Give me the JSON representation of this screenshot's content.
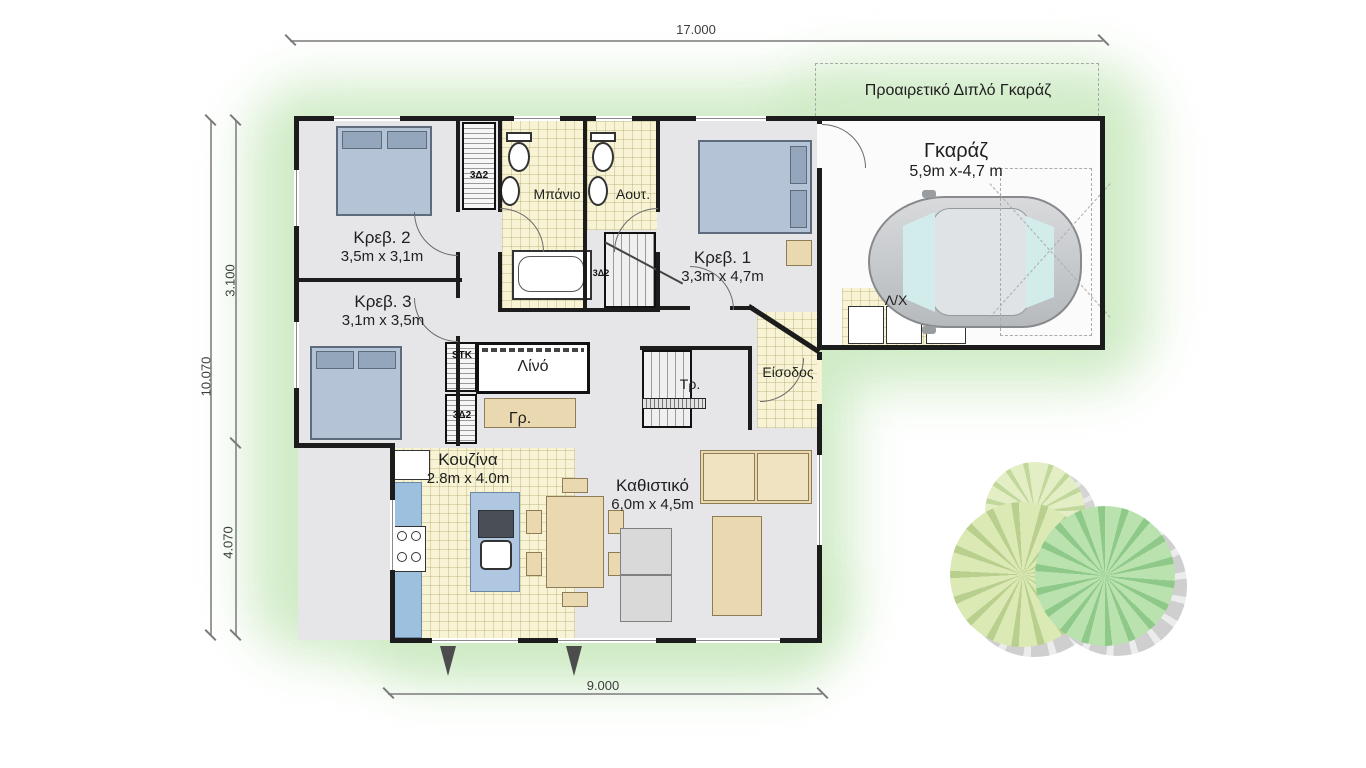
{
  "plan": {
    "type": "floor-plan",
    "language": "Greek",
    "optional_garage_note": "Προαιρετικό Διπλό Γκαράζ",
    "dims": {
      "top": "17.000",
      "bottom": "9.000",
      "left_total": "10.070",
      "left_upper": "3.100",
      "left_lower": "4.070"
    },
    "rooms": {
      "garage": {
        "name": "Γκαράζ",
        "size": "5,9m x-4,7 m"
      },
      "bed1": {
        "name": "Κρεβ. 1",
        "size": "3,3m x 4,7m"
      },
      "bed2": {
        "name": "Κρεβ. 2",
        "size": "3,5m x 3,1m"
      },
      "bed3": {
        "name": "Κρεβ. 3",
        "size": "3,1m x 3,5m"
      },
      "bath": {
        "name": "Μπάνιο"
      },
      "wc": {
        "name": "Αουτ."
      },
      "laundry": {
        "name": "Λ/Χ"
      },
      "linen": {
        "name": "Λίνό"
      },
      "study": {
        "name": "Γρ."
      },
      "stairs": {
        "name": "Τρ."
      },
      "entry": {
        "name": "Είσοδος"
      },
      "kitchen": {
        "name": "Κουζίνα",
        "size": "2.8m x 4.0m"
      },
      "living": {
        "name": "Καθιστικό",
        "size": "6,0m x 4,5m"
      }
    },
    "closets": {
      "stk": "STK",
      "c_top": "3Δ2",
      "c_mid": "3Δ2",
      "c_stair": "3Δ2"
    },
    "colors": {
      "wall": "#1c1c1c",
      "floor_gray": "#e6e6e8",
      "tile": "#f7f3d4",
      "glow_green": "#cdeac3",
      "bed_blue": "#b5c3d6",
      "counter_blue": "#9cc0de",
      "furniture_tan": "#ead9b0",
      "glass": "#d2ecec",
      "car_gray": "#c9ccce",
      "tree_pale": "#dbe9b4",
      "tree_green": "#b9e2af"
    }
  }
}
